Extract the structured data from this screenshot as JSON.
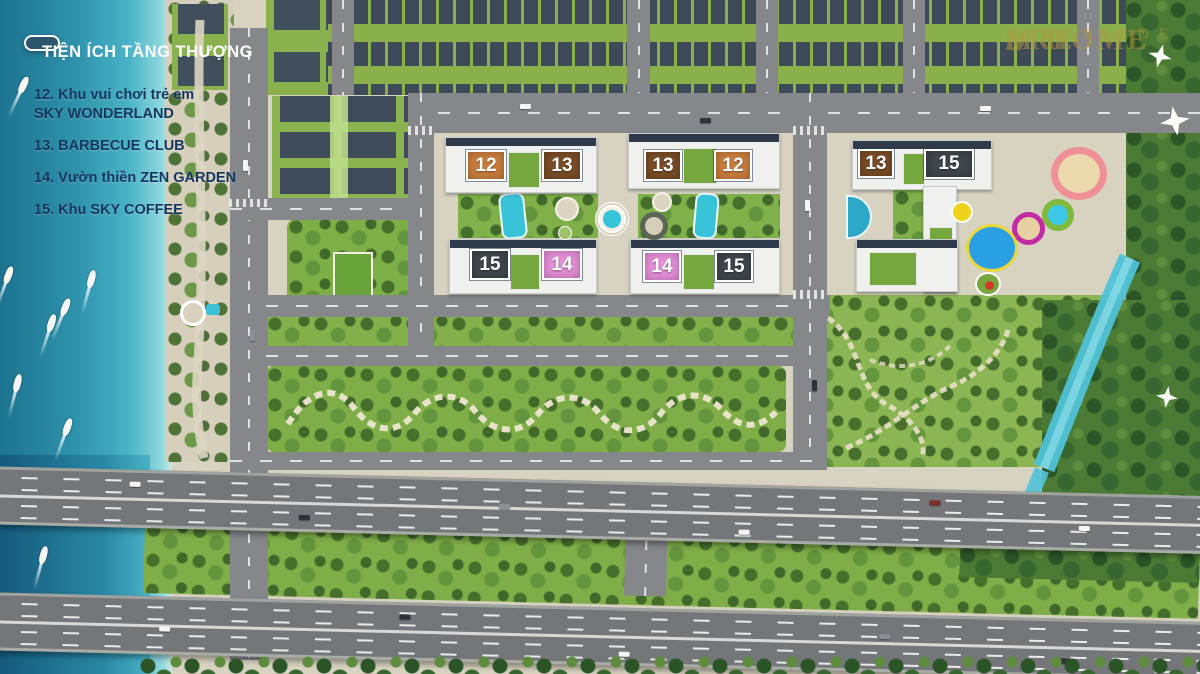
{
  "panel": {
    "title": "TIỆN ÍCH TẦNG THƯỢNG"
  },
  "legend": {
    "items": [
      {
        "lines": [
          "12. Khu vui chơi trẻ em",
          "SKY WONDERLAND"
        ]
      },
      {
        "lines": [
          "13. BARBECUE CLUB"
        ]
      },
      {
        "lines": [
          "14. Vườn thiền ZEN GARDEN"
        ]
      },
      {
        "lines": [
          "15. Khu SKY COFFEE"
        ]
      }
    ]
  },
  "badges": [
    {
      "label": "12",
      "type": "orange"
    },
    {
      "label": "13",
      "type": "brown"
    },
    {
      "label": "13",
      "type": "brown"
    },
    {
      "label": "12",
      "type": "orange"
    },
    {
      "label": "15",
      "type": "dark"
    },
    {
      "label": "14",
      "type": "pink"
    },
    {
      "label": "14",
      "type": "pink"
    },
    {
      "label": "15",
      "type": "dark"
    },
    {
      "label": "13",
      "type": "brown"
    },
    {
      "label": "15",
      "type": "dark"
    }
  ],
  "watermark": {
    "brand_left": "DRE",
    "house_glyph": "⌂",
    "brand_right": "M HOME",
    "sub": "RIVERSIDE"
  },
  "colors": {
    "badge_12_orange": "#cd7f3e",
    "badge_13_brown": "#7c4e27",
    "badge_14_pink": "#e891dc",
    "badge_15_dark": "#40474e",
    "title_box": "#2d4d63",
    "legend_text": "#14365e",
    "river_water": "#2f93ad",
    "pool_water": "#38c3d8",
    "road_asphalt": "#85878a",
    "greenery": "#7fae48",
    "watermark_gold": "#b09540"
  }
}
